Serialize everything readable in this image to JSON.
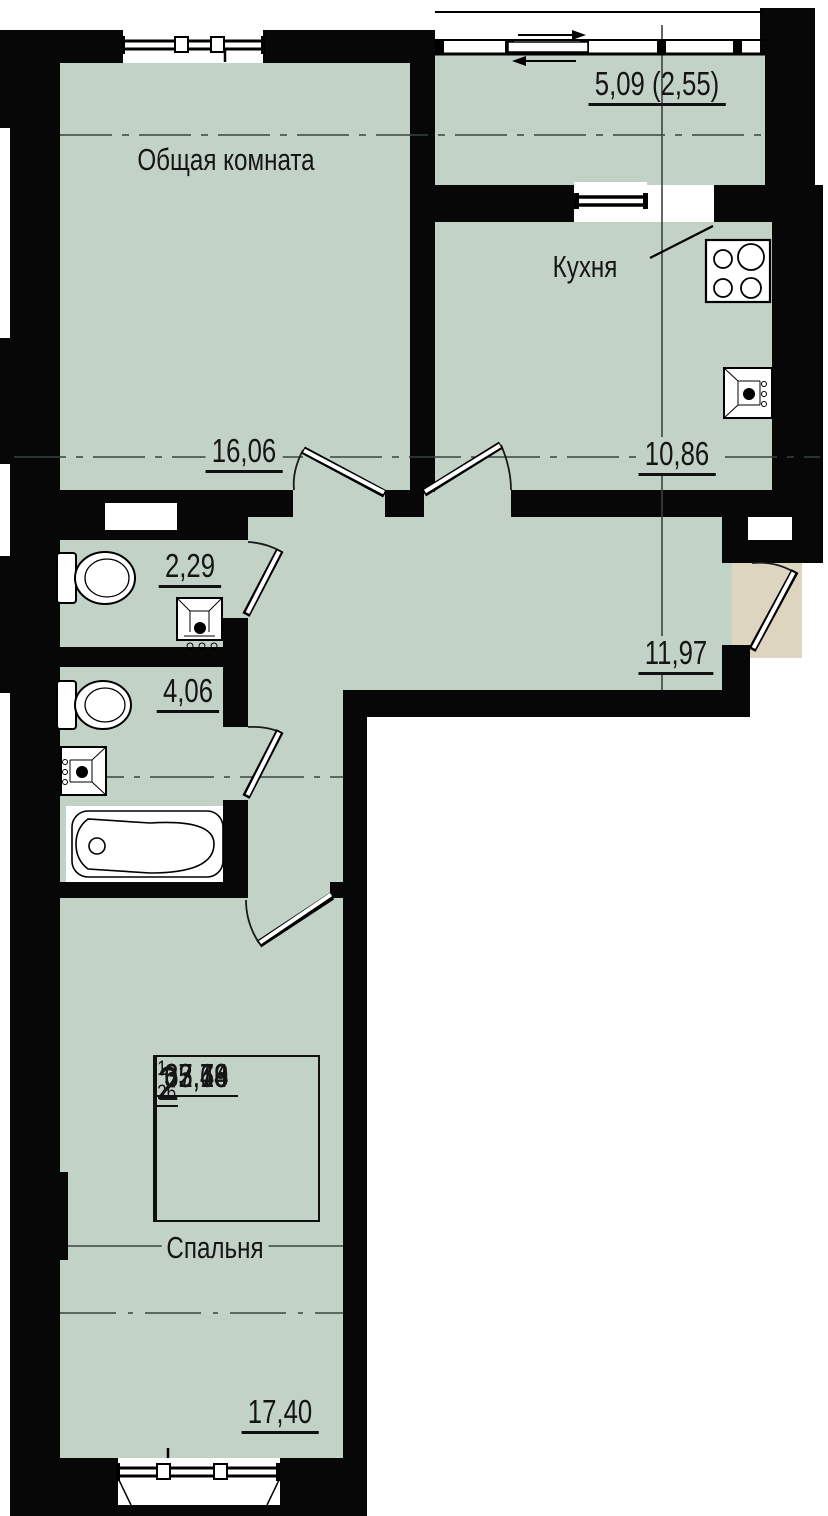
{
  "plan": {
    "rooms": {
      "living": {
        "name": "Общая комната",
        "area": "16,06"
      },
      "kitchen": {
        "name": "Кухня",
        "area": "10,86"
      },
      "balcony": {
        "area": "5,09 (2,55)"
      },
      "hall": {
        "area": "11,97"
      },
      "wc": {
        "area": "2,29"
      },
      "bathroom": {
        "area": "4,06"
      },
      "bedroom": {
        "name": "Спальня",
        "area": "17,40"
      }
    },
    "info_table": {
      "range": "1–26",
      "rooms": "2",
      "v1": "33,46",
      "v2": "62,64",
      "v3": "65,19",
      "v4": "67,73"
    },
    "colors": {
      "floor": "#c3d2c6",
      "wall": "#070707",
      "entry_pad": "#ddd5c0"
    }
  }
}
